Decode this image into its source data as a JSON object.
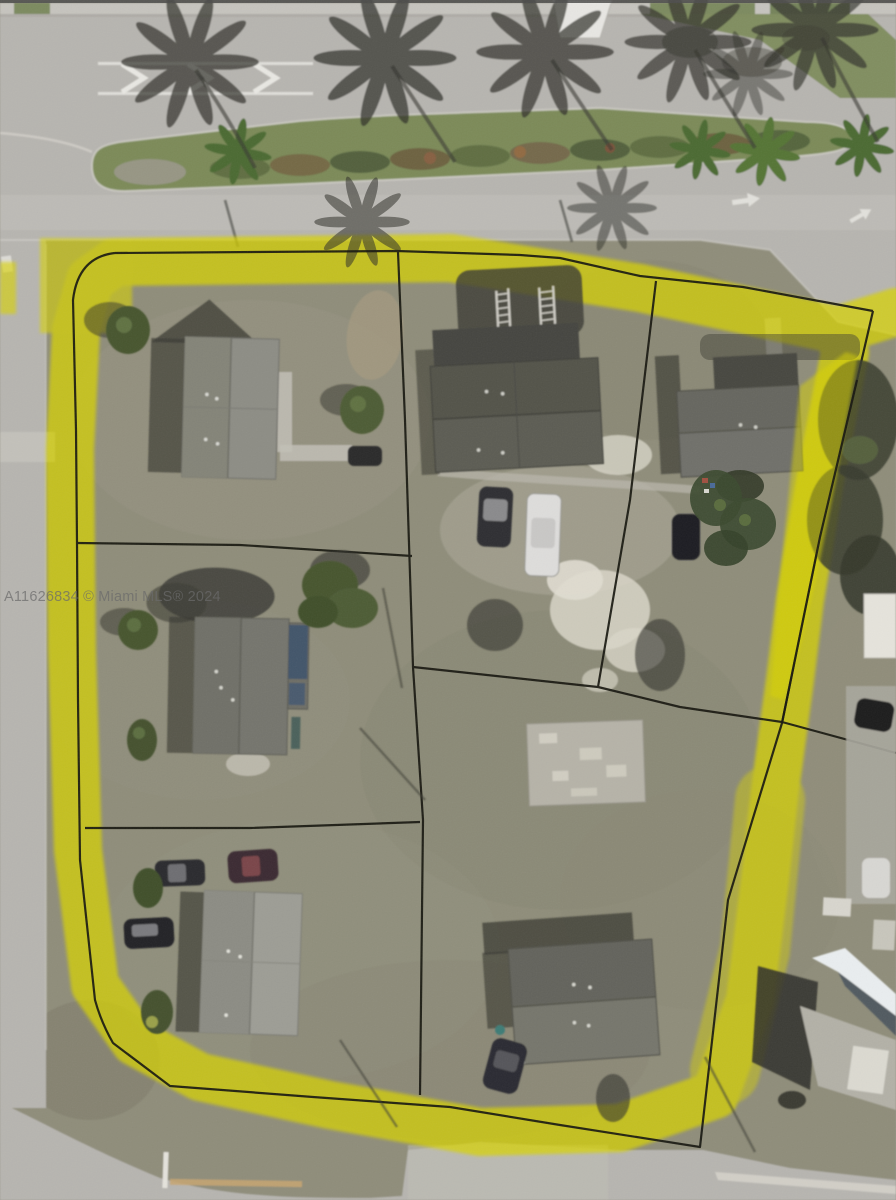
{
  "watermark": {
    "text": "A11626834 © Miami MLS® 2024"
  },
  "colors": {
    "boundary-yellow": "#d9d400",
    "parcel-line": "#17170f",
    "road": "#b7b5b0",
    "road-light": "#c6c4bf",
    "grass": "#8f8d7a",
    "grass-dark": "#7d7b69",
    "median-green": "#7b8a58",
    "palm-shadow": "#30302a",
    "house-shadow": "#3a3a33",
    "roof-gray": "#8d8d85",
    "roof-dark": "#52524a",
    "concrete": "#b6b3a8",
    "white-marking": "#e9e8e3",
    "watermark": "#6b6b6b"
  },
  "scene": {
    "houses": 6,
    "vehicles": 10,
    "palm-shadow-clusters": 6,
    "highlighted-parcel": true
  }
}
